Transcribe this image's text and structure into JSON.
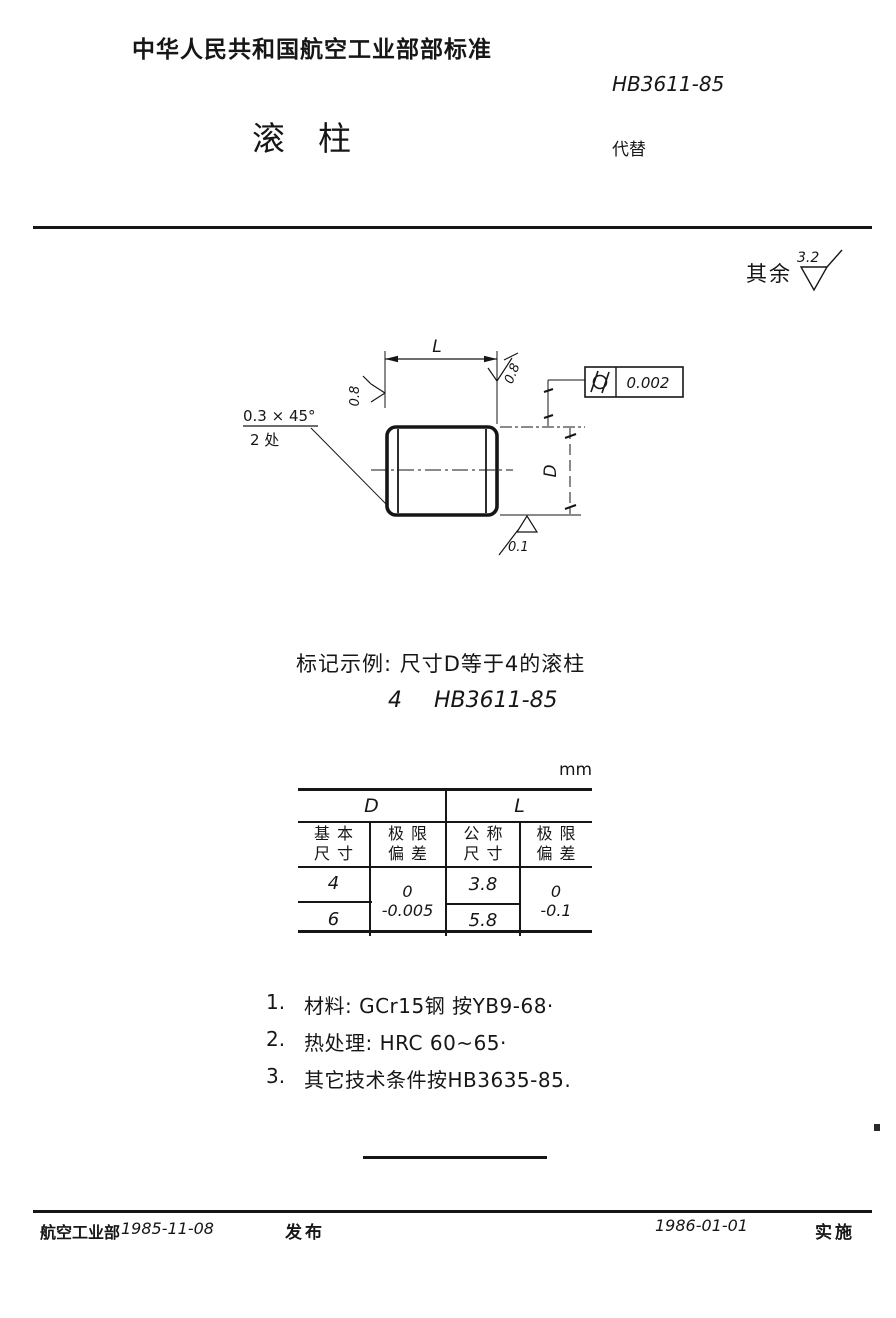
{
  "page": {
    "header": {
      "org_title": "中华人民共和国航空工业部部标准",
      "standard_no": "HB3611-85",
      "title_char1": "滚",
      "title_char2": "柱",
      "replaces_label": "代替"
    },
    "general_roughness": {
      "label": "其余",
      "value": "3.2"
    },
    "drawing": {
      "length_label": "L",
      "diameter_label": "D",
      "chamfer_text": "0.3 × 45°",
      "chamfer_places": "2 处",
      "roughness_top_left": "0.8",
      "roughness_top_right": "0.8",
      "roughness_bottom": "0.1",
      "tolerance_symbol": "cylindricity",
      "tolerance_value": "0.002"
    },
    "marking_example": {
      "line1": "标记示例: 尺寸D等于4的滚柱",
      "size_value": "4",
      "designation": "HB3611-85"
    },
    "table": {
      "unit_label": "mm",
      "group_d": "D",
      "group_l": "L",
      "headers": [
        {
          "line1": "基本",
          "line2": "尺寸"
        },
        {
          "line1": "极限",
          "line2": "偏差"
        },
        {
          "line1": "公称",
          "line2": "尺寸"
        },
        {
          "line1": "极限",
          "line2": "偏差"
        }
      ],
      "d_basic": [
        "4",
        "6"
      ],
      "d_tolerance": {
        "upper": "0",
        "lower": "-0.005"
      },
      "l_nominal": [
        "3.8",
        "5.8"
      ],
      "l_tolerance": {
        "upper": "0",
        "lower": "-0.1"
      }
    },
    "notes": [
      {
        "num": "1.",
        "text": "材料: GCr15钢 按YB9-68·"
      },
      {
        "num": "2.",
        "text": "热处理: HRC 60~65·"
      },
      {
        "num": "3.",
        "text": "其它技术条件按HB3635-85."
      }
    ],
    "footer": {
      "org": "航空工业部",
      "release_date": "1985-11-08",
      "release_label": "发布",
      "implement_date": "1986-01-01",
      "implement_label": "实施"
    }
  }
}
